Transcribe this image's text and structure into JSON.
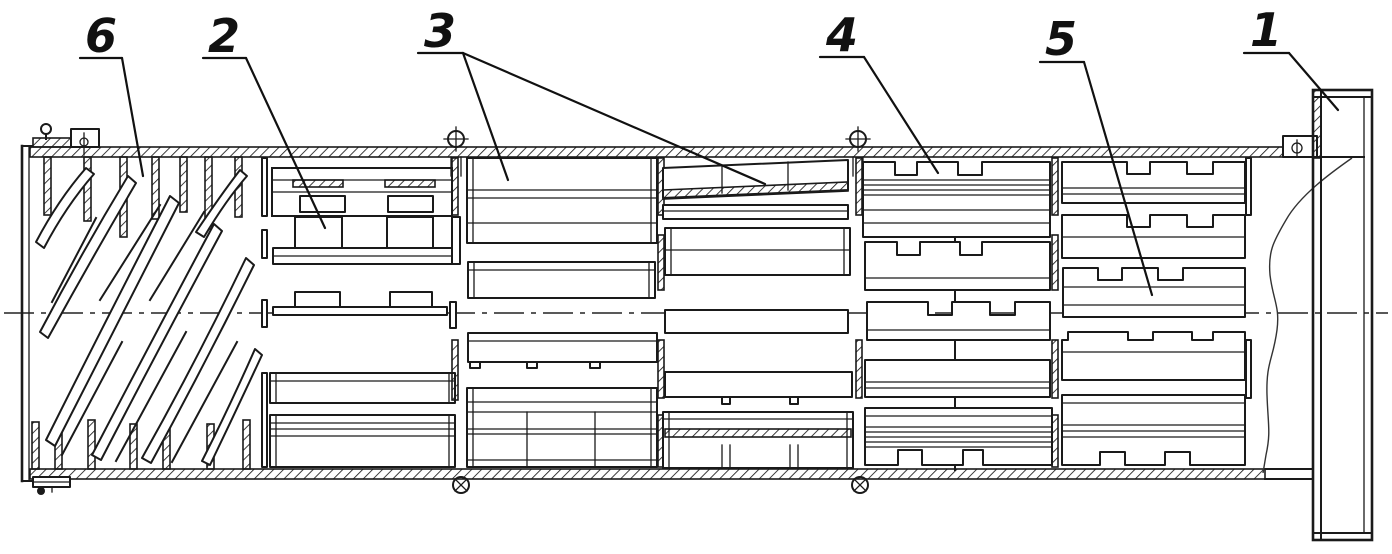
{
  "drawing": {
    "background": "#ffffff",
    "line_color": "#1a1a1a",
    "callouts": [
      {
        "label": "6"
      },
      {
        "label": "2"
      },
      {
        "label": "3"
      },
      {
        "label": "4"
      },
      {
        "label": "5"
      },
      {
        "label": "1"
      }
    ]
  }
}
